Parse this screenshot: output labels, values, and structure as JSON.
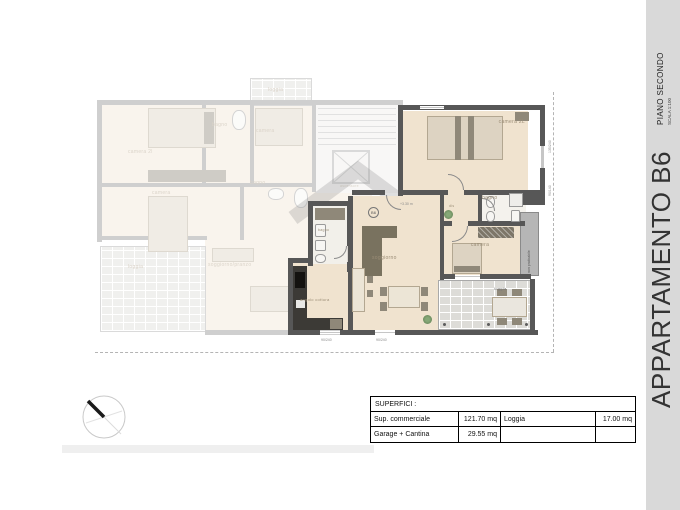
{
  "sheet": {
    "floor": "PIANO SECONDO",
    "scale": "SCALA 1:100",
    "apartment": "APPARTAMENTO B6"
  },
  "table": {
    "header": "SUPERFICI :",
    "rows": [
      [
        "Sup. commerciale",
        "121.70 mq",
        "Loggia",
        "17.00 mq"
      ],
      [
        "Garage + Cantina",
        "29.55 mq",
        "",
        ""
      ]
    ]
  },
  "b6": {
    "camera2l": "camera 2L",
    "camera": "camera",
    "bagno": "bagno",
    "bagno_small": "bagno",
    "dis": "dis",
    "soggiorno": "soggiorno",
    "cottura": "angolo cottura",
    "loggia": "loggia",
    "marker": "B6",
    "height_note": "+3.30 m",
    "strip_note": "non praticabile",
    "dim_window_right": "135/240",
    "dim_window_bagno": "90/140",
    "dim_window_bottom1": "90/240",
    "dim_window_bottom2": "90/240"
  },
  "faded": {
    "camera2l": "camera 2l",
    "bagno_top": "bagno",
    "camera_top": "camera",
    "camera_mid": "camera",
    "bagno_mid": "bagno",
    "soggiorno": "soggiorno/pranzo",
    "loggia_bottom": "loggia",
    "loggia_top": "loggia",
    "ascensore": "ascensore"
  },
  "colors": {
    "wall": "#575757",
    "floor_b6": "#f0e3cf",
    "sidebar_bg": "#d9d9d9",
    "table_border": "#000000"
  }
}
